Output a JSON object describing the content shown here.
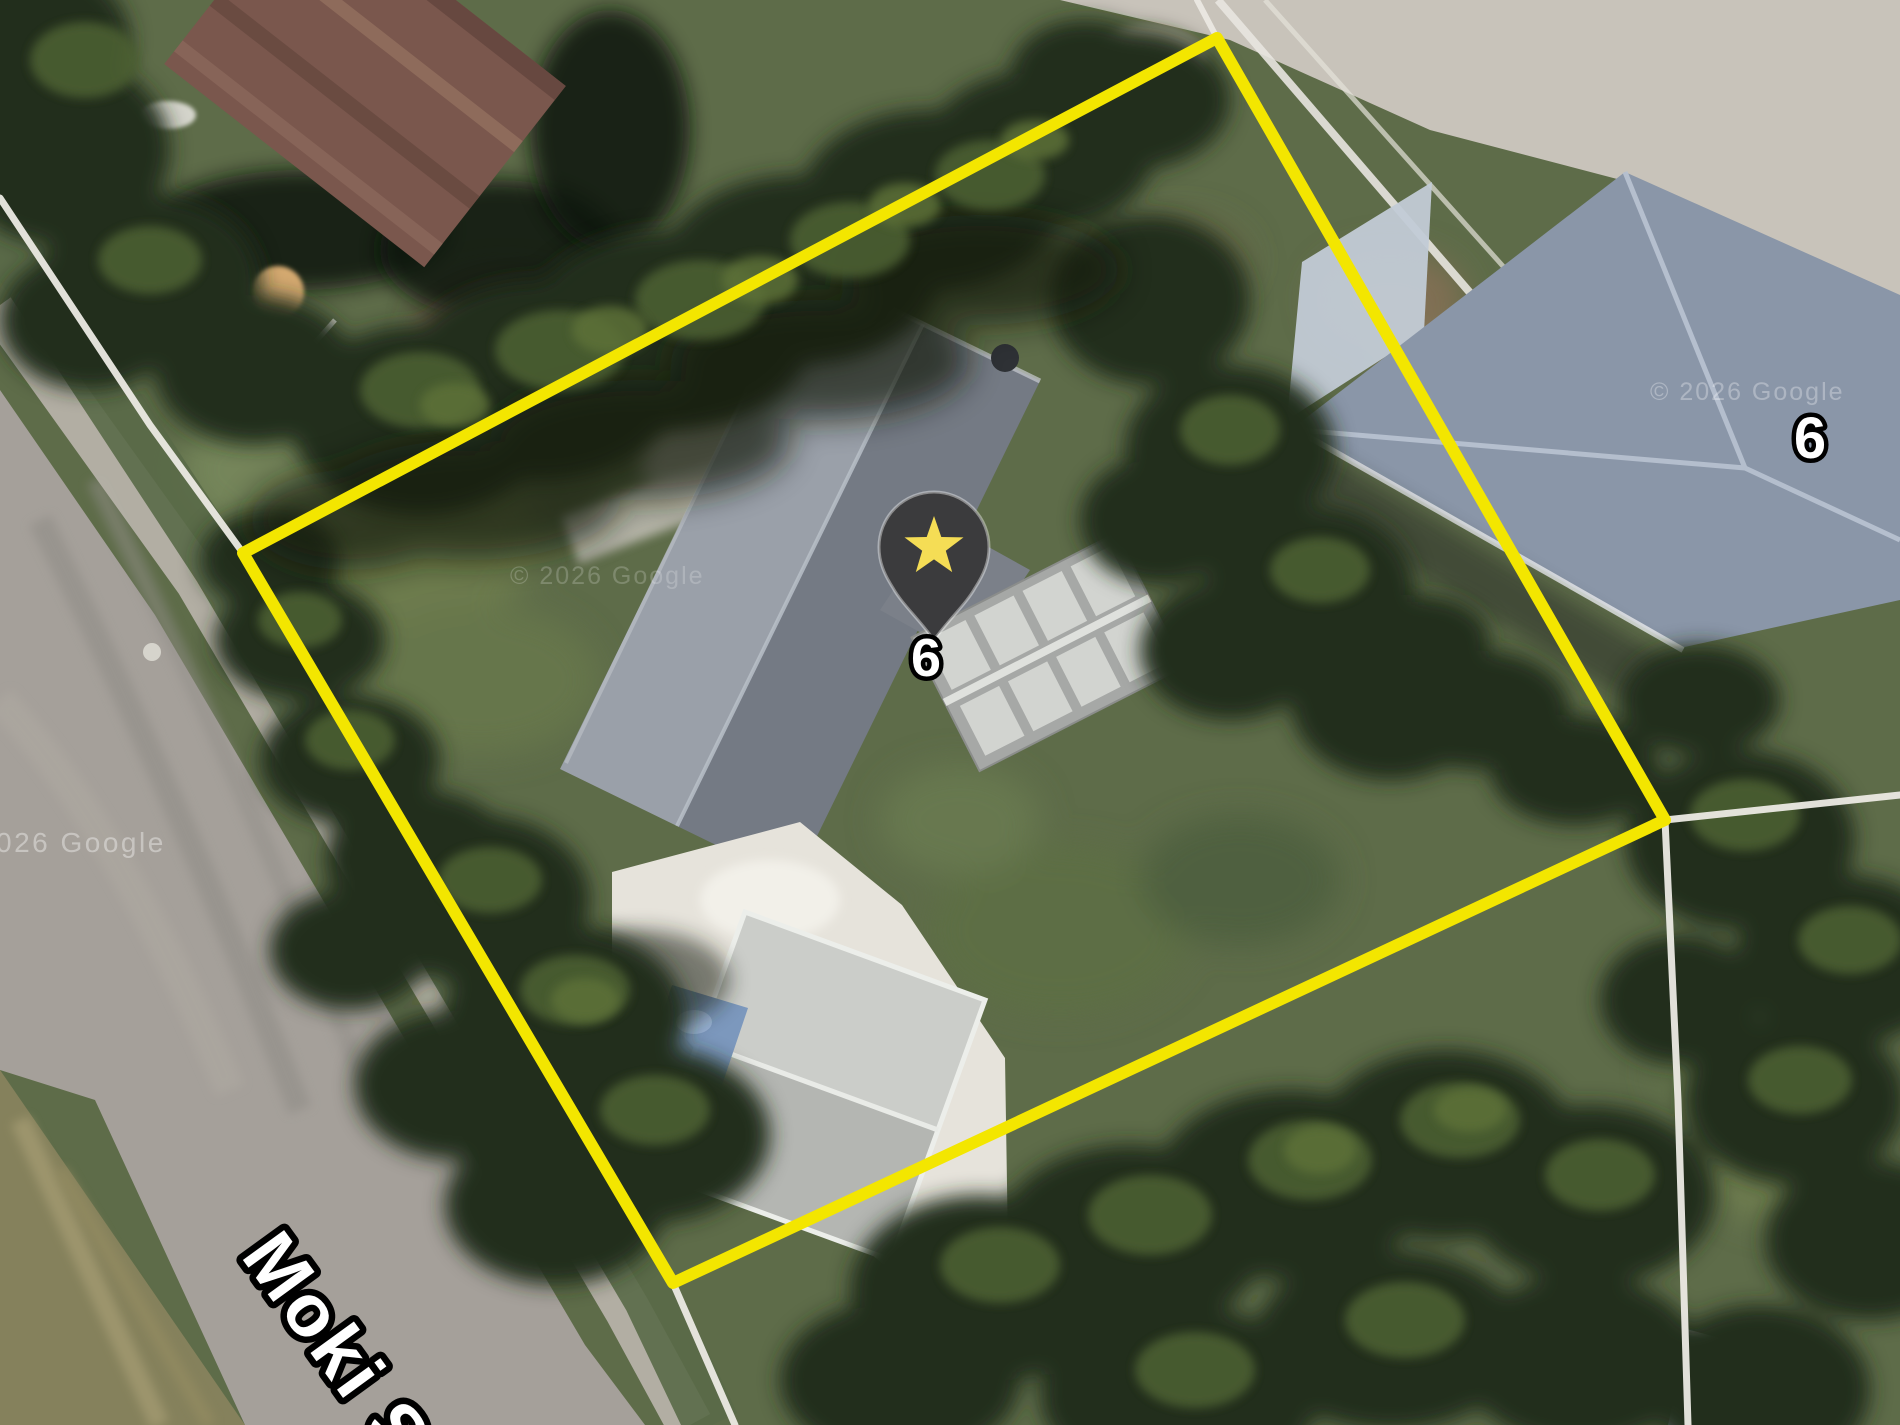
{
  "map": {
    "street_label": "Moki S",
    "marker": {
      "label": "6"
    },
    "neighbor_label": "6",
    "watermark_left": "026 Google",
    "watermark_center": "© 2026 Google",
    "watermark_right": "© 2026 Google",
    "boundary_points": "243,553 1217,38 1665,820 673,1283",
    "colors": {
      "boundary": "#f3e600",
      "pin": "#3b3b3d",
      "star": "#f5dd55",
      "label_fill": "#ffffff",
      "label_stroke": "#000000",
      "cadastral_line": "#eceae4"
    }
  }
}
